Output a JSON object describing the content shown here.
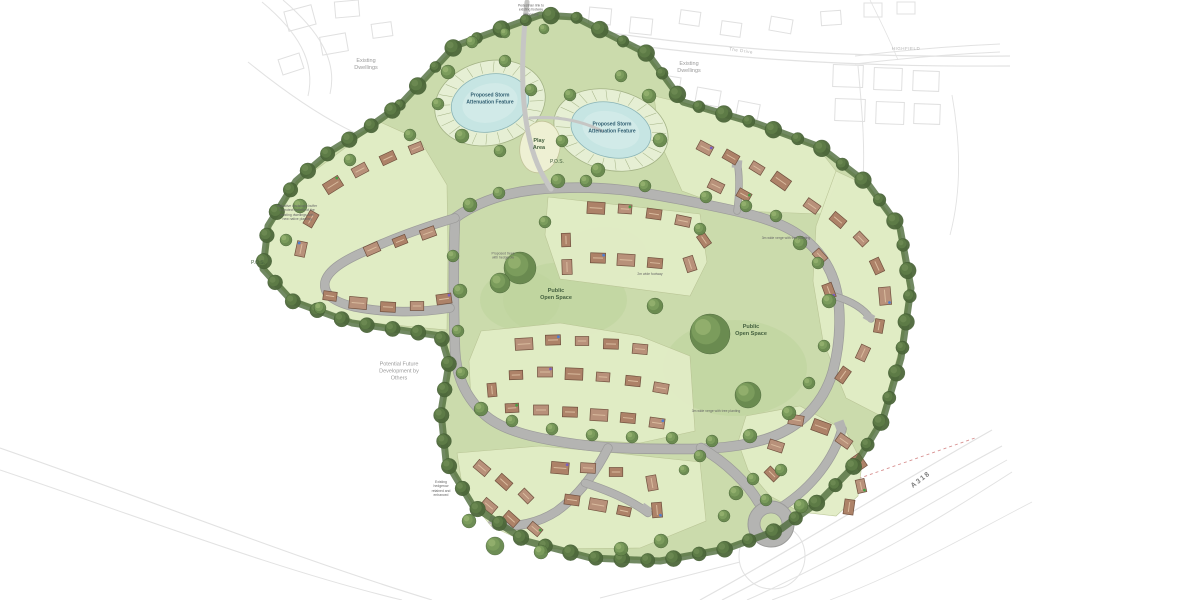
{
  "title": "Residential development masterplan site layout",
  "colors": {
    "site_green": "#cbdbac",
    "parcel_green": "#e2edc6",
    "parcel_edge": "#b9c495",
    "pos_green": "#bdd39d",
    "road_gray": "#b4b4b2",
    "road_edge": "#9b9b99",
    "pond_blue": "#c6e5e3",
    "pond_inner": "#d6ecea",
    "pond_ring": "#e6efd4",
    "ring_line": "#a3b285",
    "tree_green": "#66874c",
    "boundary_green": "#4e6b3b",
    "roof_brown": "#ad8268",
    "roof_alt": "#b8917a",
    "roof_edge": "#70503e",
    "ridge": "#d9bb9e",
    "play_cream": "#eef0d3",
    "play_edge": "#c2c49a",
    "context_gray": "#e2e2e2",
    "red_dash": "#d79090",
    "dot_colors": [
      "#44a044",
      "#7a5fc0",
      "#4f7fd0"
    ]
  },
  "labels": {
    "pond1": {
      "text": "Proposed Storm\nAttenuation Feature",
      "x": 490,
      "y": 99
    },
    "pond2": {
      "text": "Proposed Storm\nAttenuation Feature",
      "x": 612,
      "y": 128
    },
    "play": {
      "text": "Play\nArea",
      "x": 539,
      "y": 145
    },
    "pos1": {
      "text": "P.O.S.",
      "x": 557,
      "y": 162
    },
    "pos2": {
      "text": "P.O.S.",
      "x": 258,
      "y": 263
    },
    "open1": {
      "text": "Public\nOpen Space",
      "x": 556,
      "y": 295
    },
    "open2": {
      "text": "Public\nOpen Space",
      "x": 751,
      "y": 331
    },
    "future": {
      "text": "Potential Future\nDevelopment by\nOthers",
      "x": 399,
      "y": 372
    },
    "exist1": {
      "text": "Existing\nDwellings",
      "x": 366,
      "y": 65
    },
    "exist2": {
      "text": "Existing\nDwellings",
      "x": 689,
      "y": 68
    },
    "drive": {
      "text": "The Drive",
      "x": 741,
      "y": 51,
      "rot": 8
    },
    "highfield": {
      "text": "HIGHFIELD",
      "x": 906,
      "y": 49
    },
    "a318": {
      "text": "A318",
      "x": 921,
      "y": 480,
      "rot": -38
    },
    "ann_top": {
      "text": "Pedestrian link to\nexisting footway\nalong lane",
      "x": 531,
      "y": 10
    },
    "ann_left": {
      "text": "Indicative landscape buffer\nto protect outlook of the\nexisting dwellings with\nnew native planting",
      "x": 297,
      "y": 213
    },
    "ann_sw": {
      "text": "Existing\nhedgerow\nretained and\nenhanced",
      "x": 441,
      "y": 489
    },
    "ann_verge": {
      "text": "3m wide verge with tree planting",
      "x": 786,
      "y": 238
    },
    "ann_verge2": {
      "text": "3m wide verge with tree planting",
      "x": 716,
      "y": 411
    },
    "ann_path": {
      "text": "2m wide footway",
      "x": 650,
      "y": 274
    },
    "ann_trees": {
      "text": "Proposed trees\nwith hedgerow",
      "x": 503,
      "y": 256
    }
  },
  "map": {
    "site_outline": "400,105 455,46 540,15 575,17 648,54 683,102 758,124 820,147 868,184 900,228 911,288 901,358 883,419 856,464 821,500 781,529 726,549 660,561 591,558 526,541 473,506 446,461 441,412 449,363 441,336 352,323 292,301 263,269 268,226 296,181 331,151 368,128",
    "parcels": [
      "298,183 380,122 420,140 447,185 448,250 447,330 352,321 294,299 266,268 270,226",
      "548,197 700,214 707,262 690,296 560,279 545,235",
      "654,96 683,103 758,125 818,148 840,176 822,214 737,211 682,191 660,142",
      "836,171 868,186 898,230 908,290 898,355 881,416 846,398 823,341 813,281 816,226",
      "746,416 800,406 846,431 862,463 858,496 836,516 800,512 770,496 748,470 738,442",
      "481,331 560,323 640,336 690,356 695,431 640,443 560,439 500,429 471,401 469,361",
      "457,453 540,446 616,453 700,462 706,521 640,548 540,549 491,526 463,491"
    ],
    "pos_blobs": [
      [
        565,
        300,
        62,
        38
      ],
      [
        735,
        368,
        72,
        48
      ],
      [
        605,
        255,
        42,
        28
      ],
      [
        520,
        300,
        40,
        30
      ]
    ],
    "ponds": [
      {
        "cx": 490,
        "cy": 103,
        "rx": 56,
        "ry": 42,
        "rot": -14
      },
      {
        "cx": 611,
        "cy": 130,
        "rx": 58,
        "ry": 40,
        "rot": 14
      }
    ],
    "play": {
      "cx": 540,
      "cy": 147,
      "rx": 20,
      "ry": 26,
      "rot": 12
    },
    "roads": [
      {
        "d": "M455,218 C480,200 515,189 560,188 C610,186 640,192 683,200 C722,208 756,214 781,225 C806,236 826,256 834,281 C842,306 841,341 833,371 C825,399 806,421 781,433 C756,445 721,449 690,449 C650,449 610,449 575,444 C540,439 504,432 485,415 C466,398 456,376 455,350 C454,320 453,268 455,218 Z",
        "w": 9
      },
      {
        "d": "M455,218 C428,226 396,237 368,250 C344,260 328,270 325,282 C323,294 333,302 355,307 C385,313 420,313 450,308",
        "w": 8
      },
      {
        "d": "M701,448 C726,462 748,484 759,503",
        "w": 9
      },
      {
        "d": "M783,506 C812,487 834,459 842,429",
        "w": 8
      },
      {
        "d": "M608,448 C596,472 579,495 557,511 C539,523 516,528 496,525",
        "w": 8
      },
      {
        "d": "M585,483 C610,491 632,501 648,513",
        "w": 7
      },
      {
        "d": "M834,296 C852,301 864,309 871,319",
        "w": 6
      },
      {
        "d": "M737,211 C739,196 740,182 738,167",
        "w": 6
      }
    ],
    "paths": [
      {
        "d": "M527,2 C522,45 520,92 528,132 C533,158 541,174 551,189",
        "w": 5
      },
      {
        "d": "M530,118 C558,116 582,121 602,131",
        "w": 3
      }
    ],
    "hammers": [
      [
        494,
        521,
        20
      ],
      [
        646,
        509,
        35
      ],
      [
        840,
        425,
        -20
      ],
      [
        737,
        164,
        5
      ],
      [
        869,
        317,
        30
      ]
    ],
    "roundabout": {
      "cx": 771,
      "cy": 524,
      "r": 23,
      "inner": 11
    },
    "houses": [
      [
        333,
        185,
        -32
      ],
      [
        360,
        170,
        -28
      ],
      [
        388,
        158,
        -25
      ],
      [
        416,
        148,
        -22
      ],
      [
        311,
        219,
        -60
      ],
      [
        301,
        249,
        -78
      ],
      [
        330,
        296,
        8
      ],
      [
        358,
        303,
        5
      ],
      [
        388,
        307,
        3
      ],
      [
        417,
        306,
        0
      ],
      [
        444,
        299,
        -8
      ],
      [
        372,
        249,
        -24
      ],
      [
        400,
        241,
        -22
      ],
      [
        428,
        233,
        -20
      ],
      [
        596,
        208,
        3
      ],
      [
        625,
        209,
        4
      ],
      [
        654,
        214,
        8
      ],
      [
        683,
        221,
        12
      ],
      [
        566,
        240,
        88
      ],
      [
        567,
        267,
        88
      ],
      [
        598,
        258,
        2
      ],
      [
        626,
        260,
        3
      ],
      [
        655,
        263,
        5
      ],
      [
        690,
        264,
        72
      ],
      [
        704,
        240,
        55
      ],
      [
        705,
        148,
        28
      ],
      [
        731,
        157,
        30
      ],
      [
        757,
        168,
        32
      ],
      [
        781,
        181,
        35
      ],
      [
        716,
        186,
        26
      ],
      [
        744,
        195,
        29
      ],
      [
        812,
        206,
        35
      ],
      [
        838,
        220,
        40
      ],
      [
        861,
        239,
        46
      ],
      [
        877,
        266,
        65
      ],
      [
        885,
        296,
        85
      ],
      [
        879,
        326,
        100
      ],
      [
        863,
        353,
        115
      ],
      [
        843,
        375,
        125
      ],
      [
        820,
        256,
        48
      ],
      [
        829,
        291,
        70
      ],
      [
        796,
        420,
        10
      ],
      [
        821,
        427,
        20
      ],
      [
        844,
        441,
        35
      ],
      [
        859,
        462,
        55
      ],
      [
        861,
        486,
        78
      ],
      [
        849,
        507,
        98
      ],
      [
        776,
        446,
        18
      ],
      [
        772,
        474,
        45
      ],
      [
        524,
        344,
        -3
      ],
      [
        553,
        340,
        -2
      ],
      [
        582,
        341,
        0
      ],
      [
        611,
        344,
        2
      ],
      [
        640,
        349,
        5
      ],
      [
        516,
        375,
        -2
      ],
      [
        545,
        372,
        0
      ],
      [
        574,
        374,
        2
      ],
      [
        603,
        377,
        4
      ],
      [
        633,
        381,
        6
      ],
      [
        661,
        388,
        10
      ],
      [
        512,
        408,
        -3
      ],
      [
        541,
        410,
        0
      ],
      [
        570,
        412,
        2
      ],
      [
        599,
        415,
        3
      ],
      [
        628,
        418,
        5
      ],
      [
        657,
        423,
        8
      ],
      [
        492,
        390,
        85
      ],
      [
        482,
        468,
        40
      ],
      [
        504,
        482,
        42
      ],
      [
        526,
        496,
        45
      ],
      [
        560,
        468,
        5
      ],
      [
        588,
        468,
        3
      ],
      [
        616,
        472,
        0
      ],
      [
        489,
        506,
        40
      ],
      [
        511,
        519,
        42
      ],
      [
        535,
        529,
        40
      ],
      [
        572,
        500,
        8
      ],
      [
        598,
        505,
        10
      ],
      [
        624,
        511,
        12
      ],
      [
        652,
        483,
        80
      ],
      [
        657,
        510,
        85
      ]
    ],
    "trees": [
      [
        448,
        72,
        7
      ],
      [
        438,
        104,
        6
      ],
      [
        462,
        136,
        7
      ],
      [
        505,
        61,
        6
      ],
      [
        531,
        90,
        6
      ],
      [
        472,
        42,
        6
      ],
      [
        570,
        95,
        6
      ],
      [
        562,
        141,
        6
      ],
      [
        598,
        170,
        7
      ],
      [
        649,
        96,
        7
      ],
      [
        660,
        140,
        7
      ],
      [
        621,
        76,
        6
      ],
      [
        505,
        33,
        5
      ],
      [
        544,
        29,
        5
      ],
      [
        500,
        151,
        6
      ],
      [
        558,
        181,
        7
      ],
      [
        470,
        205,
        7
      ],
      [
        499,
        193,
        6
      ],
      [
        586,
        181,
        6
      ],
      [
        645,
        186,
        6
      ],
      [
        706,
        197,
        6
      ],
      [
        746,
        206,
        6
      ],
      [
        776,
        216,
        6
      ],
      [
        800,
        243,
        7
      ],
      [
        818,
        263,
        6
      ],
      [
        829,
        301,
        7
      ],
      [
        824,
        346,
        6
      ],
      [
        809,
        383,
        6
      ],
      [
        789,
        413,
        7
      ],
      [
        750,
        436,
        7
      ],
      [
        712,
        441,
        6
      ],
      [
        672,
        438,
        6
      ],
      [
        632,
        437,
        6
      ],
      [
        592,
        435,
        6
      ],
      [
        552,
        429,
        6
      ],
      [
        512,
        421,
        6
      ],
      [
        481,
        409,
        7
      ],
      [
        462,
        373,
        6
      ],
      [
        458,
        331,
        6
      ],
      [
        460,
        291,
        7
      ],
      [
        453,
        256,
        6
      ],
      [
        520,
        268,
        16
      ],
      [
        500,
        283,
        10
      ],
      [
        710,
        334,
        20
      ],
      [
        748,
        395,
        13
      ],
      [
        655,
        306,
        8
      ],
      [
        736,
        493,
        7
      ],
      [
        753,
        479,
        6
      ],
      [
        801,
        506,
        7
      ],
      [
        724,
        516,
        6
      ],
      [
        700,
        456,
        6
      ],
      [
        684,
        470,
        5
      ],
      [
        781,
        470,
        6
      ],
      [
        766,
        500,
        6
      ],
      [
        495,
        546,
        9
      ],
      [
        541,
        552,
        7
      ],
      [
        621,
        549,
        7
      ],
      [
        661,
        541,
        7
      ],
      [
        469,
        521,
        7
      ],
      [
        545,
        222,
        6
      ],
      [
        700,
        229,
        6
      ],
      [
        410,
        135,
        6
      ],
      [
        350,
        160,
        6
      ],
      [
        300,
        206,
        7
      ],
      [
        286,
        240,
        6
      ],
      [
        320,
        308,
        6
      ]
    ],
    "context": {
      "strokes": [
        {
          "d": "M543,22 C700,50 850,58 1010,56",
          "w": 1.2
        },
        {
          "d": "M543,31 C700,59 850,67 1010,66",
          "w": 1.2
        },
        {
          "d": "M262,2 C298,32 316,62 308,96",
          "w": 1
        },
        {
          "d": "M283,0 C318,30 338,60 330,94",
          "w": 1
        },
        {
          "d": "M248,62 C290,96 330,122 362,136",
          "w": 1
        },
        {
          "d": "M855,56 C905,50 955,46 1000,44",
          "w": 1
        },
        {
          "d": "M855,64 C905,58 955,54 1000,52",
          "w": 1
        },
        {
          "d": "M858,66 C862,110 866,150 862,195",
          "w": 1
        },
        {
          "d": "M952,95 C960,140 962,190 950,235",
          "w": 0.9
        },
        {
          "d": "M870,0 C880,20 890,40 898,60",
          "w": 0.8
        },
        {
          "d": "M700,600 C800,545 900,482 992,430",
          "w": 1.2
        },
        {
          "d": "M722,600 C822,550 912,494 1002,446",
          "w": 1.2
        },
        {
          "d": "M747,600 C842,558 927,505 1007,460",
          "w": 1
        },
        {
          "d": "M772,600 C862,567 942,517 1012,472",
          "w": 1
        },
        {
          "d": "M830,600 C905,572 970,534 1032,502",
          "w": 0.8
        },
        {
          "d": "M620,560 C740,520 860,478 975,438",
          "w": 0.9,
          "c": "#d79090",
          "da": "3,3"
        },
        {
          "d": "M0,448 C150,500 300,560 432,600",
          "w": 1.1
        },
        {
          "d": "M0,470 C140,517 280,571 402,600",
          "w": 1
        },
        {
          "d": "M739,556 a33,33 0 1,0 66,0 a33,33 0 1,0 -66,0",
          "w": 1
        },
        {
          "d": "M600,598 C650,585 700,572 740,562",
          "w": 1
        }
      ],
      "buildings": [
        [
          300,
          18,
          28,
          20,
          -15
        ],
        [
          334,
          44,
          26,
          18,
          -10
        ],
        [
          291,
          64,
          22,
          16,
          -18
        ],
        [
          347,
          9,
          24,
          16,
          -5
        ],
        [
          382,
          30,
          20,
          14,
          -8
        ],
        [
          600,
          16,
          22,
          16,
          5
        ],
        [
          641,
          26,
          22,
          16,
          6
        ],
        [
          690,
          18,
          20,
          14,
          8
        ],
        [
          731,
          29,
          20,
          14,
          8
        ],
        [
          781,
          25,
          22,
          14,
          10
        ],
        [
          831,
          18,
          20,
          14,
          -4
        ],
        [
          873,
          10,
          18,
          14,
          0
        ],
        [
          906,
          8,
          18,
          12,
          0
        ],
        [
          628,
          70,
          24,
          16,
          8
        ],
        [
          668,
          84,
          24,
          16,
          9
        ],
        [
          708,
          97,
          24,
          16,
          10
        ],
        [
          748,
          110,
          22,
          15,
          11
        ],
        [
          848,
          76,
          30,
          22,
          2
        ],
        [
          888,
          79,
          28,
          22,
          2
        ],
        [
          926,
          81,
          26,
          20,
          2
        ],
        [
          850,
          110,
          30,
          22,
          2
        ],
        [
          890,
          113,
          28,
          22,
          2
        ],
        [
          927,
          114,
          26,
          20,
          2
        ]
      ]
    }
  }
}
